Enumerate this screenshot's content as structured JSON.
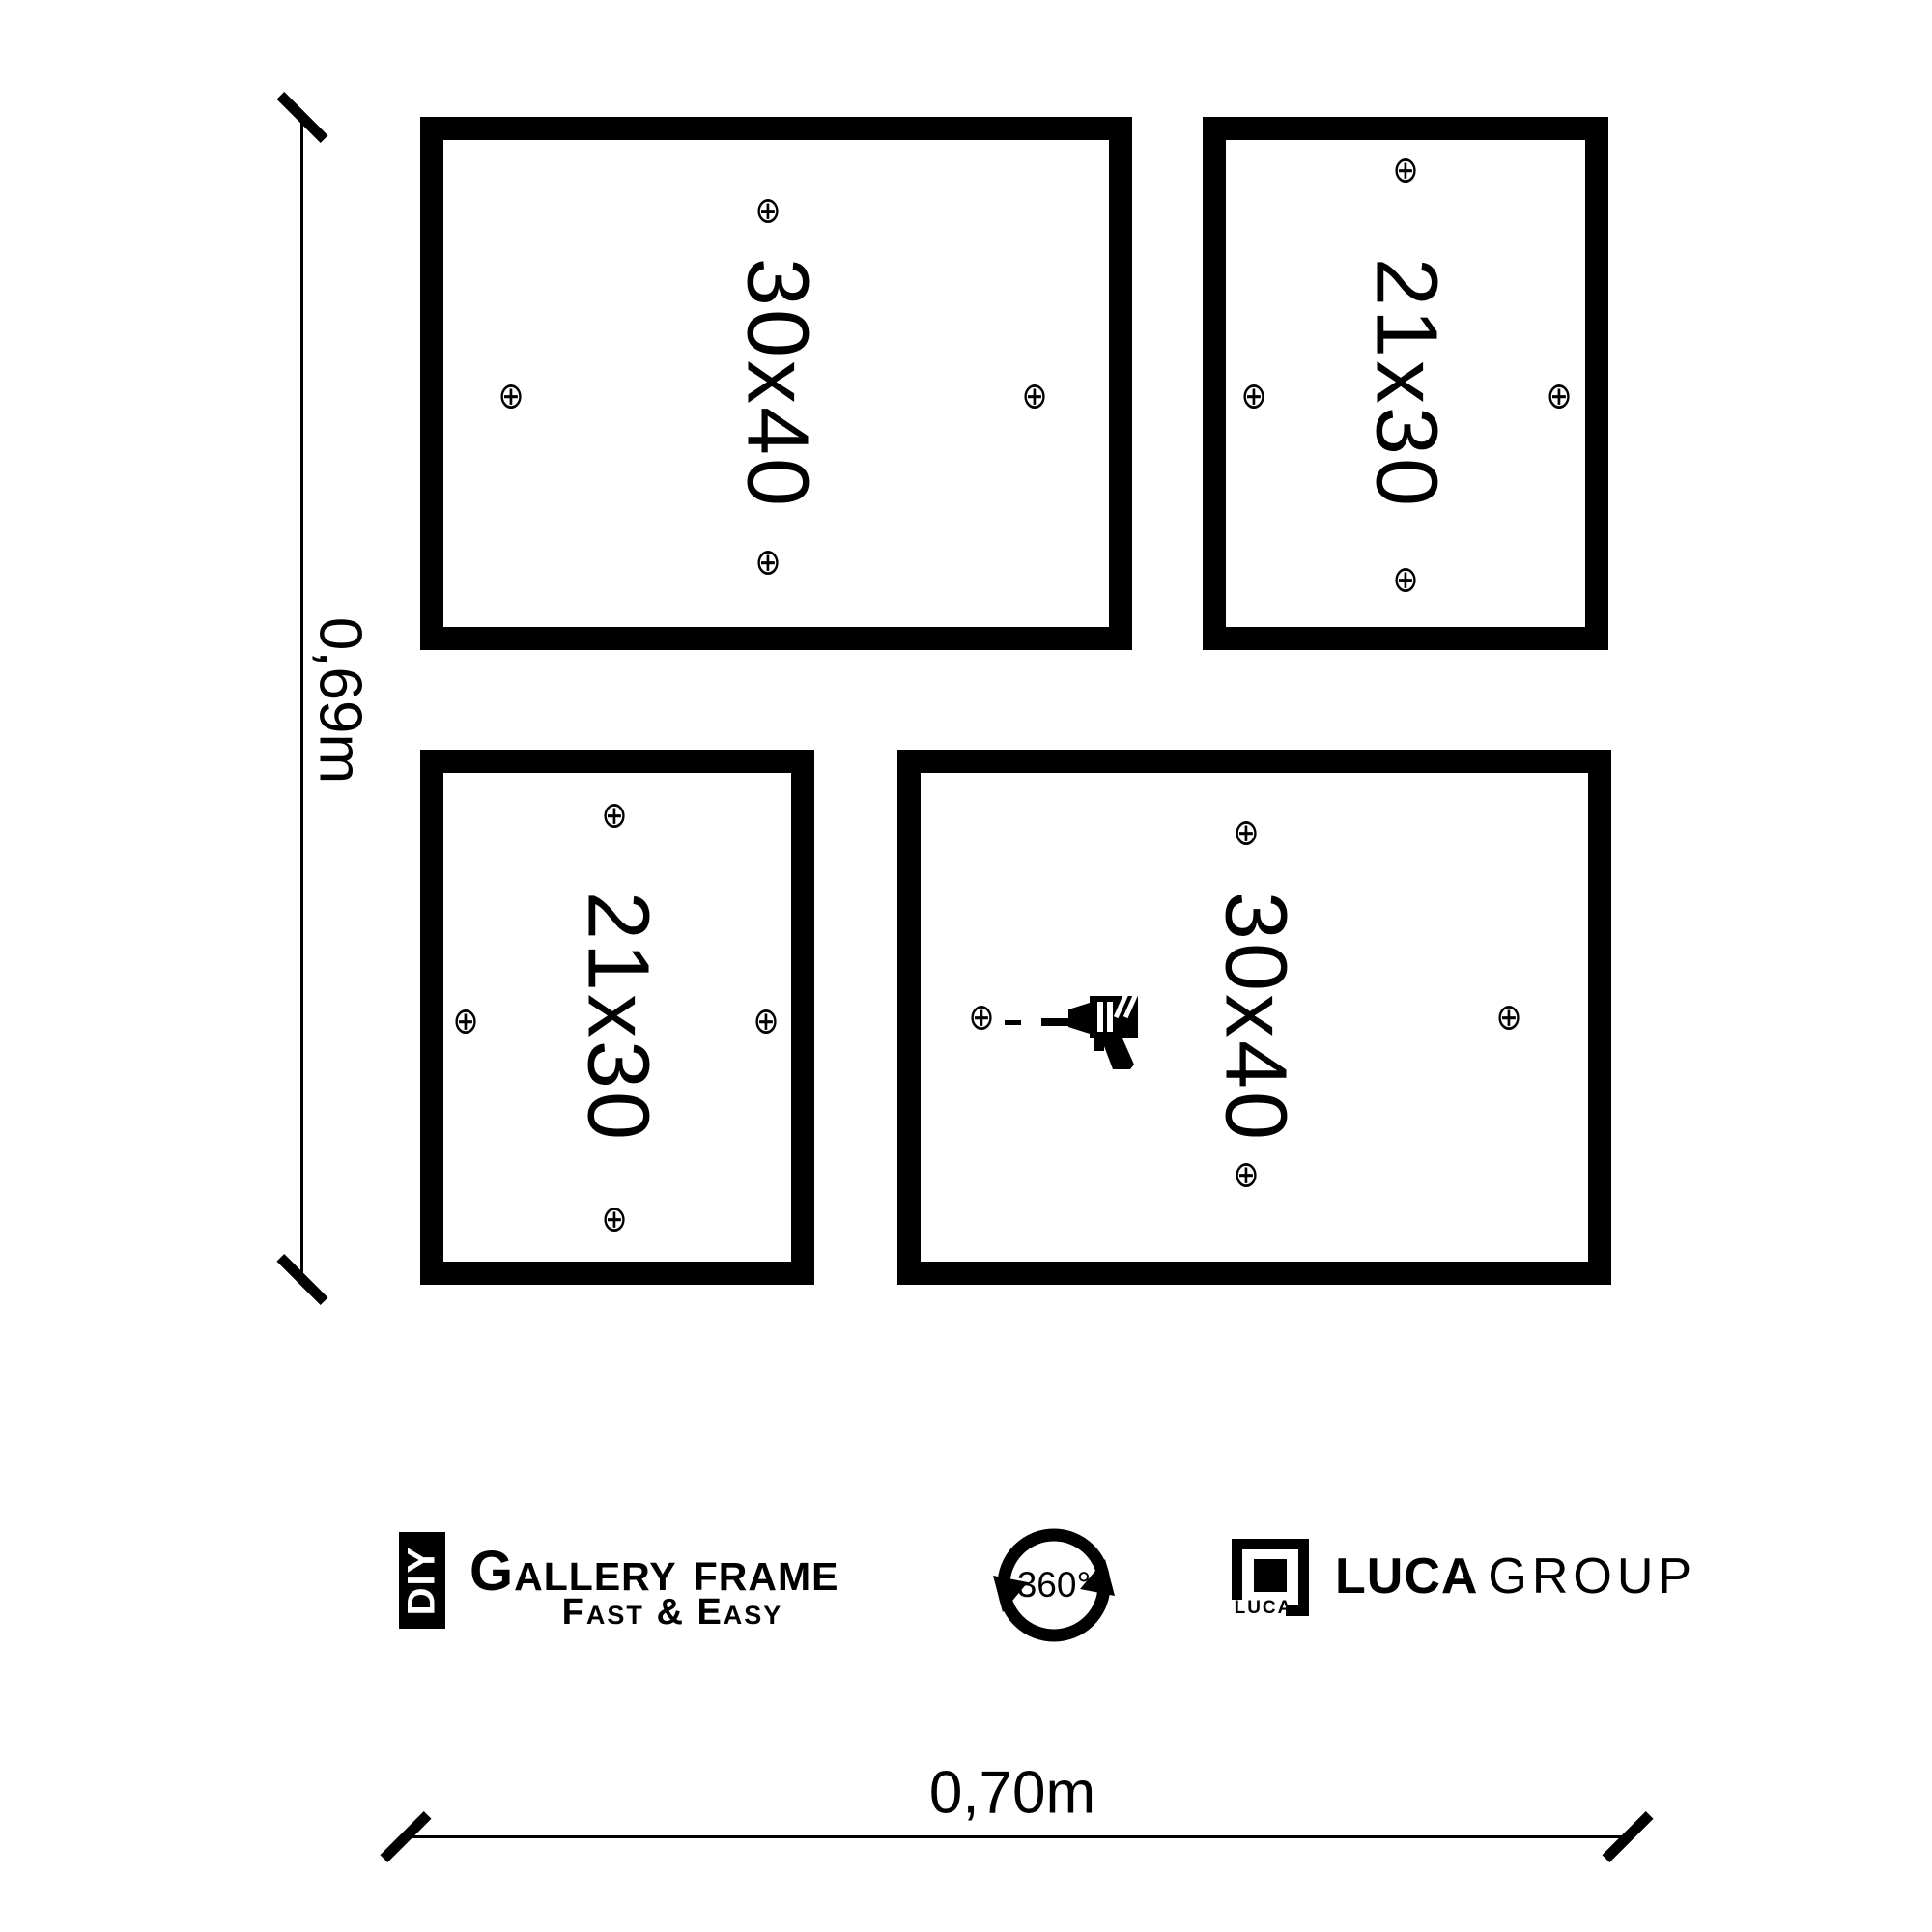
{
  "dimensions": {
    "height_label": "0,69m",
    "width_label": "0,70m"
  },
  "frames": [
    {
      "position": "top-left",
      "label": "30x40"
    },
    {
      "position": "top-right",
      "label": "21x30"
    },
    {
      "position": "bottom-left",
      "label": "21x30"
    },
    {
      "position": "bottom-right",
      "label": "30x40"
    }
  ],
  "marker_glyph": "⊕",
  "branding": {
    "diy_badge": "DIY",
    "product_name": "Gallery Frame",
    "tagline": "Fast & Easy",
    "rotation_badge": "360°",
    "logo_box_label": "LUCA",
    "company_name_bold": "LUCA",
    "company_name_light": "GROUP"
  },
  "colors": {
    "ink": "#000000",
    "background": "#ffffff"
  }
}
